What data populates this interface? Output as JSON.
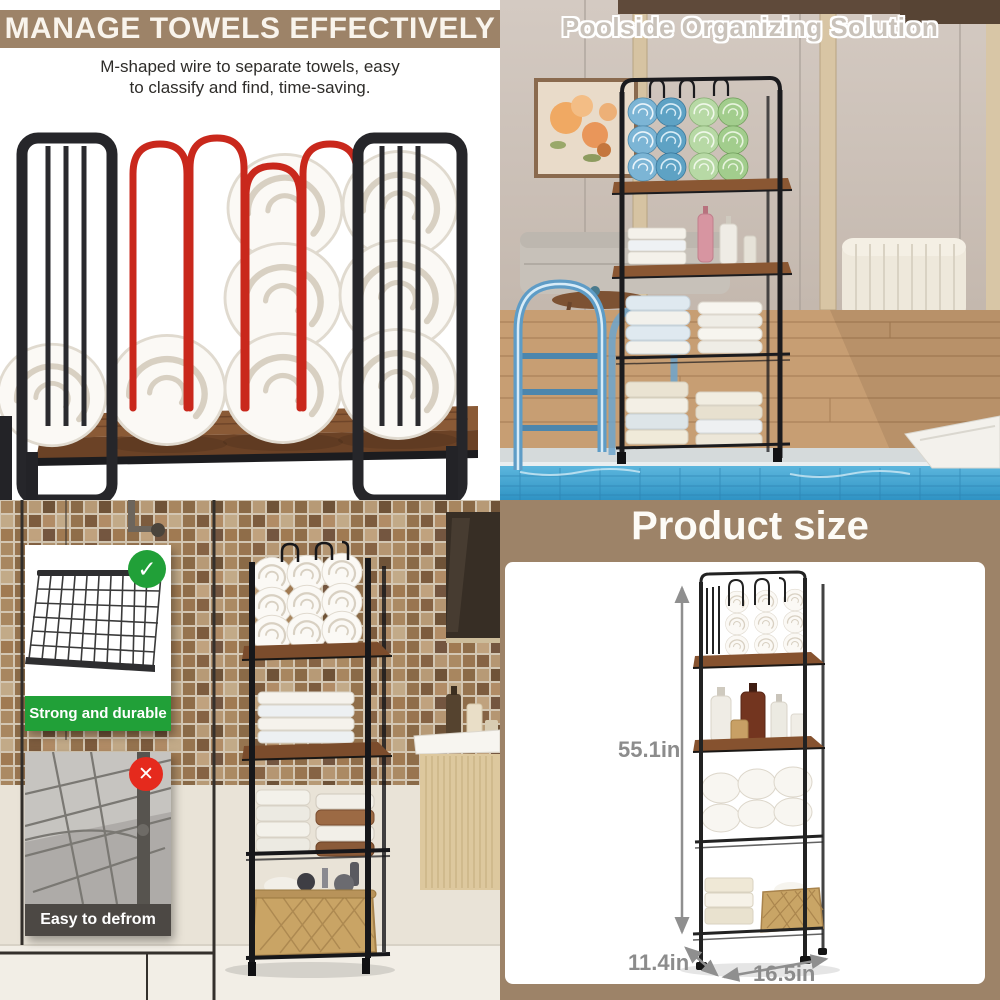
{
  "panel_manage": {
    "title": "MANAGE TOWELS EFFECTIVELY",
    "desc_line1": "M-shaped wire to separate towels, easy",
    "desc_line2": "to classify and find, time-saving."
  },
  "panel_poolside": {
    "title": "Poolside Organizing Solution"
  },
  "panel_bathroom": {
    "durable_caption": "Strong and durable",
    "deform_caption": "Easy to defrom",
    "check_icon": "✓",
    "cross_icon": "✕"
  },
  "panel_size": {
    "title": "Product size",
    "height": "55.1in",
    "depth": "11.4in",
    "width": "16.5in"
  },
  "colors": {
    "taupe": "#9d8368",
    "green": "#21a038",
    "red": "#e52a1d",
    "wire": "#c9281c",
    "wood": "#7b4c2c",
    "metal": "#222226",
    "dim_gray": "#8c8c8c"
  }
}
